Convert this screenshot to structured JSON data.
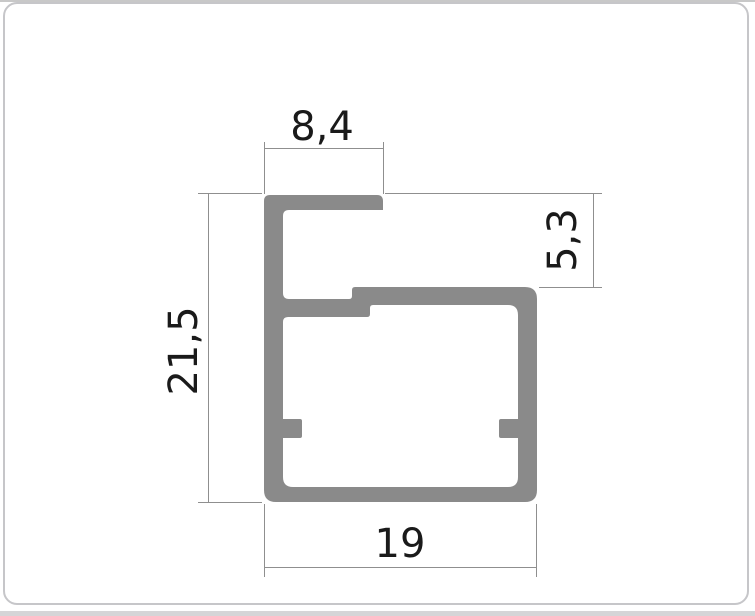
{
  "drawing": {
    "dimensions": {
      "top": {
        "label": "8,4"
      },
      "left": {
        "label": "21,5"
      },
      "right": {
        "label": "5,3"
      },
      "bottom": {
        "label": "19"
      }
    },
    "colors": {
      "profile_fill": "#8a8a8a",
      "dimension_lines": "#8f8f8f",
      "dimension_text": "#1a1a1a",
      "card_border": "#c6c6c9",
      "top_strip": "#c8c8c8",
      "bottom_strip": "#d5d5d7"
    }
  }
}
